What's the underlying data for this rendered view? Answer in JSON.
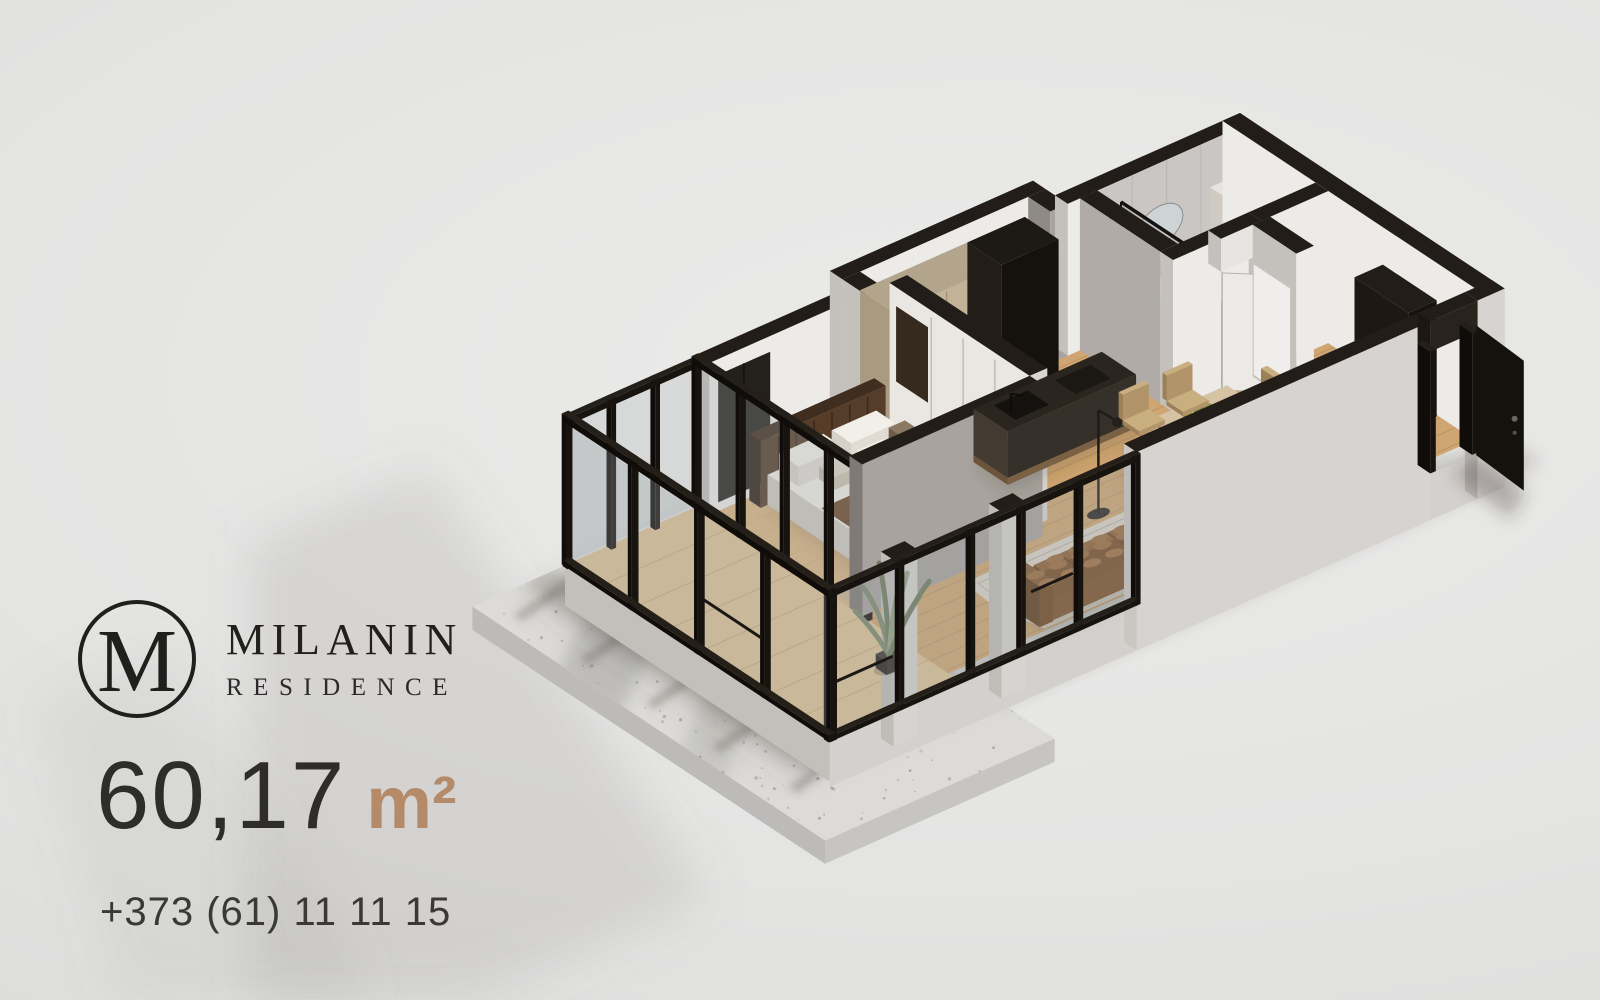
{
  "brand": {
    "monogram": "M",
    "name": "MILANIN",
    "subtitle": "RESIDENCE"
  },
  "listing": {
    "area_value": "60,17",
    "area_unit": "m²",
    "phone": "+373 (61) 11 11 15"
  },
  "colors": {
    "background": "#e4e4e3",
    "accent": "#b58a68",
    "text_dark": "#242322",
    "wall_top_dark": "#221d19",
    "wall_outer": "#d6d3d0",
    "wall_inner": "#edebe8",
    "wall_gray": "#a8a39e",
    "frame_black": "#17130f",
    "glass_tint": "#9aa2a6",
    "wood_floor": "#cfa571",
    "wood_light": "#dcbb8b",
    "terrace_concrete": "#dcdbd9",
    "sofa_brown": "#8a5a2e",
    "rug": "#d9d3c7",
    "bed_linen": "#efece6",
    "duvet_brown": "#6b4829",
    "headboard_brown": "#4b3523",
    "cabinet_beige": "#c2b298",
    "island_dark": "#2a251f",
    "dining_table": "#d5c3a3",
    "chair_tan": "#c0a477",
    "bath_tile": "#c9c6c3",
    "bath_floor": "#b2afac",
    "door_black": "#15110d",
    "plant_green": "#7c8a6d"
  }
}
